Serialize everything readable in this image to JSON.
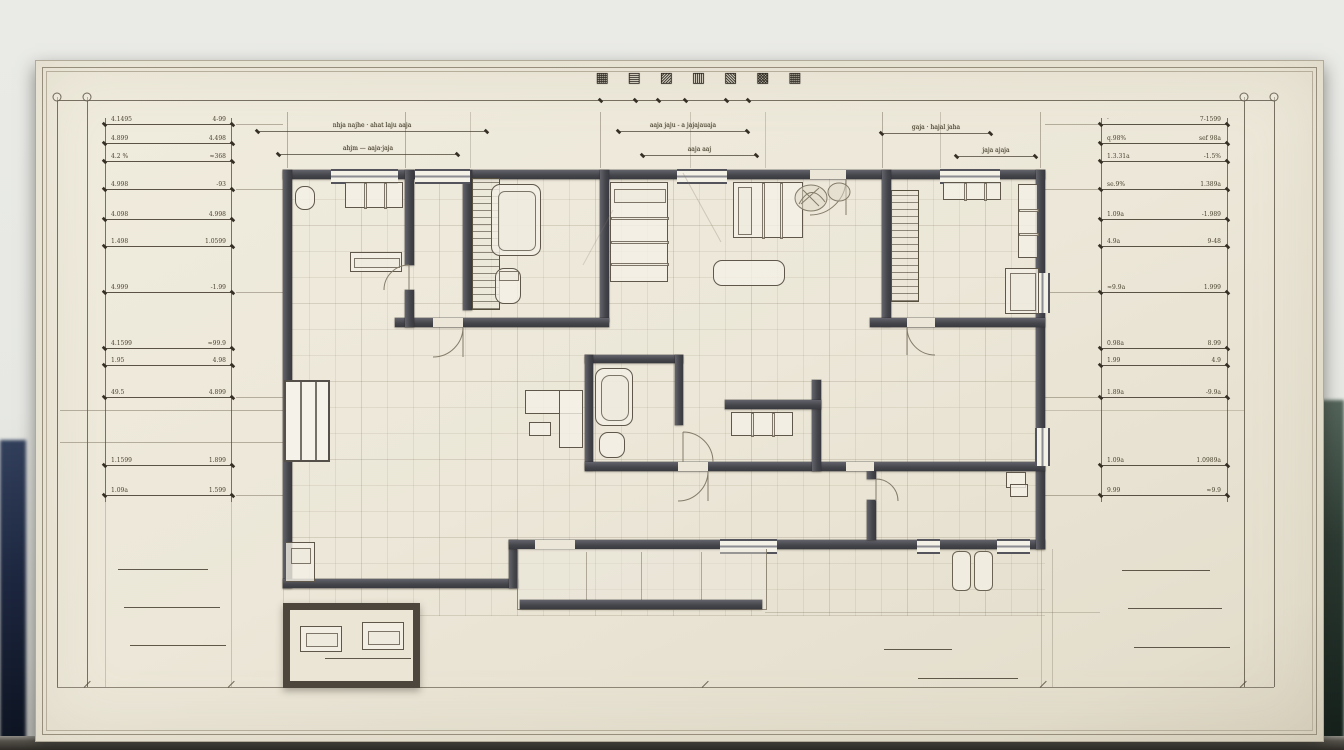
{
  "colors": {
    "paper": "#ece7d8",
    "wall_dark": "#44444b",
    "ink_line": "#6e675a",
    "text_ink": "#49422f",
    "backdrop": "#e7e8e4",
    "backdrop_left_dark": "#1d2740",
    "backdrop_right_dark": "#2c3b33",
    "table_strip": "#2f2c27"
  },
  "title": {
    "glyphs": "▦ ▤ ▨ ▥ ▧ ▩ ▦"
  },
  "top_dims": {
    "row1": [
      {
        "x": 257,
        "y": 122,
        "w": 230,
        "t": "nhja najhe · ahat laju aaja"
      },
      {
        "x": 618,
        "y": 122,
        "w": 130,
        "t": "aaja jaju - a jajajauaja"
      },
      {
        "x": 881,
        "y": 124,
        "w": 110,
        "t": "gaja · hajal jaha"
      }
    ],
    "row2": [
      {
        "x": 278,
        "y": 145,
        "w": 180,
        "t": "ahjm — aaja·jaja"
      },
      {
        "x": 642,
        "y": 146,
        "w": 115,
        "t": "aaja aaj"
      },
      {
        "x": 956,
        "y": 147,
        "w": 80,
        "t": "jaja ajaja"
      }
    ]
  },
  "left_ladder": {
    "rows": [
      {
        "y": 124,
        "l": "4.1495",
        "r": "4-99"
      },
      {
        "y": 143,
        "l": "4.899",
        "r": "4.498"
      },
      {
        "y": 161,
        "l": "4.2 %",
        "r": "≈368"
      },
      {
        "y": 189,
        "l": "4.998",
        "r": "-93"
      },
      {
        "y": 219,
        "l": "4.098",
        "r": "4.998"
      },
      {
        "y": 246,
        "l": "1.498",
        "r": "1.0599"
      },
      {
        "y": 292,
        "l": "4.999",
        "r": "-1.99"
      },
      {
        "y": 348,
        "l": "4.1599",
        "r": "≈99.9"
      },
      {
        "y": 365,
        "l": "1.95",
        "r": "4.98"
      },
      {
        "y": 397,
        "l": "49.5",
        "r": "4.899"
      },
      {
        "y": 465,
        "l": "1.1599",
        "r": "1.899"
      },
      {
        "y": 495,
        "l": "1.09a",
        "r": "1.599"
      }
    ]
  },
  "right_ladder": {
    "rows": [
      {
        "y": 124,
        "l": "·",
        "r": "7-1599"
      },
      {
        "y": 143,
        "l": "q.98%",
        "r": "sef 98a"
      },
      {
        "y": 161,
        "l": "1.3.31a",
        "r": "-1.5%"
      },
      {
        "y": 189,
        "l": "se.9%",
        "r": "1.389a"
      },
      {
        "y": 219,
        "l": "1.09a",
        "r": "-1.989"
      },
      {
        "y": 246,
        "l": "4.9a",
        "r": "9-48"
      },
      {
        "y": 292,
        "l": "≈9.9a",
        "r": "1.999"
      },
      {
        "y": 348,
        "l": "0.98a",
        "r": "8.99"
      },
      {
        "y": 365,
        "l": "1.99",
        "r": "4.9"
      },
      {
        "y": 397,
        "l": "1.89a",
        "r": "-9.9a"
      },
      {
        "y": 465,
        "l": "1.09a",
        "r": "1.0989a"
      },
      {
        "y": 495,
        "l": "9.99",
        "r": "≈9.9"
      }
    ]
  },
  "plan_labels": [
    {
      "x": 318,
      "y": 238,
      "t": "mwmav"
    },
    {
      "x": 318,
      "y": 248,
      "t": "nmxnv"
    },
    {
      "x": 425,
      "y": 252,
      "t": "nmandinne"
    },
    {
      "x": 508,
      "y": 249,
      "t": "mxnz"
    },
    {
      "x": 534,
      "y": 259,
      "t": "måme"
    },
    {
      "x": 630,
      "y": 236,
      "t": "asthí"
    },
    {
      "x": 630,
      "y": 246,
      "t": "mnuna"
    },
    {
      "x": 732,
      "y": 187,
      "t": "pañlawaunu"
    },
    {
      "x": 726,
      "y": 271,
      "t": "lanavao"
    },
    {
      "x": 816,
      "y": 251,
      "t": "jañadiatava"
    },
    {
      "x": 932,
      "y": 231,
      "t": "asfawwal asta"
    },
    {
      "x": 738,
      "y": 299,
      "t": "masovai"
    },
    {
      "x": 613,
      "y": 388,
      "t": "avam"
    },
    {
      "x": 290,
      "y": 355,
      "t": "mvma"
    },
    {
      "x": 400,
      "y": 434,
      "t": "jmmanev"
    },
    {
      "x": 505,
      "y": 496,
      "t": "tsildammna"
    },
    {
      "x": 828,
      "y": 414,
      "t": "a pvvt"
    },
    {
      "x": 938,
      "y": 414,
      "t": "ahha å aaaaaa"
    },
    {
      "x": 676,
      "y": 456,
      "t": "whadow"
    },
    {
      "x": 748,
      "y": 453,
      "t": "tdaw"
    },
    {
      "x": 822,
      "y": 526,
      "t": "mmmawvv"
    },
    {
      "x": 1012,
      "y": 441,
      "t": "1503"
    },
    {
      "x": 1016,
      "y": 488,
      "t": "gd"
    },
    {
      "x": 325,
      "y": 646,
      "t": "wawwhamd nmfwr"
    }
  ],
  "notes": [
    {
      "x": 560,
      "y": 90,
      "t": "≈sraw·e"
    },
    {
      "x": 790,
      "y": 91,
      "t": "–⊖–"
    },
    {
      "x": 138,
      "y": 170,
      "t": "≈ mnwvnna · L-504"
    },
    {
      "x": 168,
      "y": 418,
      "t": "dbmavwvnadt mvtmvl"
    },
    {
      "x": 198,
      "y": 428,
      "t": "f.lnwv å/våb"
    },
    {
      "x": 1120,
      "y": 274,
      "t": "q88h 104b"
    },
    {
      "x": 1128,
      "y": 529,
      "t": "ûlavt wvm"
    },
    {
      "x": 120,
      "y": 560,
      "t": "jj.ham.wav"
    },
    {
      "x": 126,
      "y": 598,
      "t": "å.jwdbav.1wv"
    },
    {
      "x": 132,
      "y": 636,
      "t": "ff.1wb5.10w"
    },
    {
      "x": 1124,
      "y": 561,
      "t": "aufwv.dm"
    },
    {
      "x": 1130,
      "y": 599,
      "t": "tawuta wvaw"
    },
    {
      "x": 1136,
      "y": 638,
      "t": "bð.wv5.vwb"
    },
    {
      "x": 465,
      "y": 572,
      "t": "apoím"
    },
    {
      "x": 538,
      "y": 562,
      "t": "wajna"
    },
    {
      "x": 556,
      "y": 583,
      "t": "solkvputt jasfdww"
    },
    {
      "x": 430,
      "y": 621,
      "t": "dålz karvhammm"
    },
    {
      "x": 692,
      "y": 591,
      "t": "łaamj mamam"
    },
    {
      "x": 598,
      "y": 638,
      "t": "tbacrwv då"
    },
    {
      "x": 676,
      "y": 642,
      "t": "⌐ mammar-nv"
    },
    {
      "x": 681,
      "y": 656,
      "t": "⌐ spawoundd"
    },
    {
      "x": 886,
      "y": 641,
      "t": "≈..aßm ———"
    },
    {
      "x": 973,
      "y": 641,
      "t": "⌐⌐d.lav/mam"
    },
    {
      "x": 932,
      "y": 670,
      "t": "(.kvio4dåbõahr"
    }
  ],
  "underlines": [
    {
      "x": 118,
      "y": 569,
      "w": 90
    },
    {
      "x": 124,
      "y": 607,
      "w": 96
    },
    {
      "x": 130,
      "y": 645,
      "w": 96
    },
    {
      "x": 1122,
      "y": 570,
      "w": 88
    },
    {
      "x": 1128,
      "y": 608,
      "w": 94
    },
    {
      "x": 1134,
      "y": 647,
      "w": 96
    },
    {
      "x": 884,
      "y": 649,
      "w": 68
    },
    {
      "x": 918,
      "y": 678,
      "w": 100
    },
    {
      "x": 325,
      "y": 658,
      "w": 86
    }
  ]
}
